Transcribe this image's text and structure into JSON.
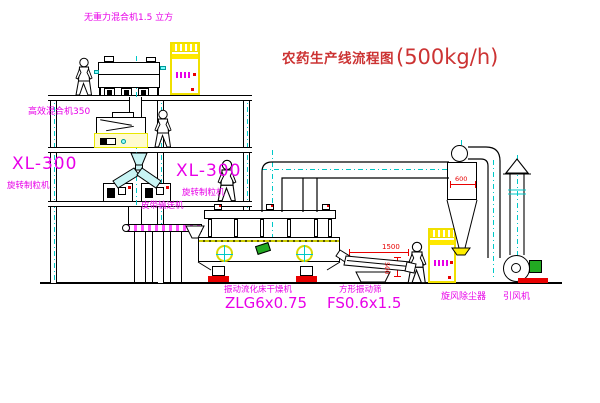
{
  "title": {
    "name": "农药生产线流程图",
    "capacity": "(500kg/h)"
  },
  "equipment": {
    "gravity_mixer": "无重力混合机1.5 立方",
    "high_mixer": "高效混合机350",
    "granulator_left_model": "XL-300",
    "granulator_left_name": "旋转制粒机",
    "granulator_mid_model": "XL-300",
    "granulator_mid_name": "旋转制粒机",
    "belt_conveyor": "皮带输送机",
    "dryer_name": "振动流化床干燥机",
    "dryer_model": "ZLG6x0.75",
    "sieve_name": "方形振动筛",
    "sieve_model": "FS0.6x1.5",
    "cyclone": "旋风除尘器",
    "fan": "引风机"
  },
  "dims": {
    "sieve_length": "1500",
    "sieve_height": "500",
    "cyclone_dia": "600"
  },
  "colors": {
    "line": "#000000",
    "centerline": "#00c8c8",
    "label_magenta": "#e800e8",
    "title_red": "#cc3333",
    "dimension_red": "#e80000",
    "cabinet_yellow": "#ffe800",
    "motor_green": "#22aa22",
    "chute_cyan": "#c8f4f4"
  }
}
